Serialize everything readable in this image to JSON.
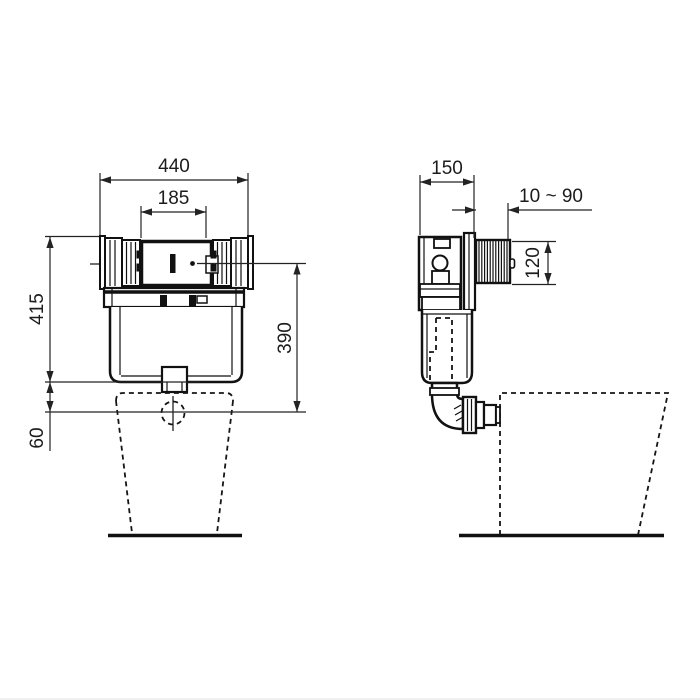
{
  "meta": {
    "background_color": "#ffffff",
    "line_color": "#111111",
    "dimension_color": "#232323"
  },
  "figure": {
    "front_view": {
      "overall_width": "440",
      "opening_width": "185",
      "frame_height": "415",
      "outlet_offset": "60",
      "panel_to_outlet": "390"
    },
    "side_view": {
      "depth": "150",
      "adjust_range": "10 ~ 90",
      "spacer_height": "120"
    }
  }
}
